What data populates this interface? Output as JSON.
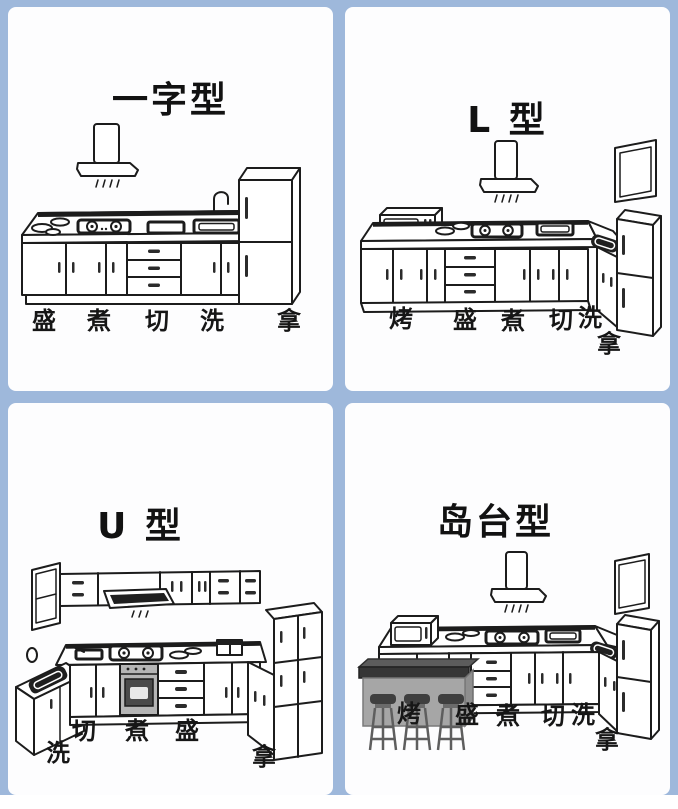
{
  "page": {
    "background_color": "#9eb8db",
    "panel_color": "#fdfdfe",
    "line_color": "#1c1c1c",
    "island_gray": "#a6a6a6"
  },
  "panels": [
    {
      "id": "inline",
      "title": "一字型",
      "labels": [
        "盛",
        "煮",
        "切",
        "洗",
        "拿"
      ]
    },
    {
      "id": "l-shape",
      "title": "L 型",
      "labels": [
        "烤",
        "盛",
        "煮",
        "切",
        "洗",
        "拿"
      ]
    },
    {
      "id": "u-shape",
      "title": "U 型",
      "labels": [
        "切",
        "煮",
        "盛",
        "洗",
        "拿"
      ]
    },
    {
      "id": "island",
      "title": "岛台型",
      "labels": [
        "烤",
        "盛",
        "煮",
        "切",
        "洗",
        "拿"
      ]
    }
  ]
}
